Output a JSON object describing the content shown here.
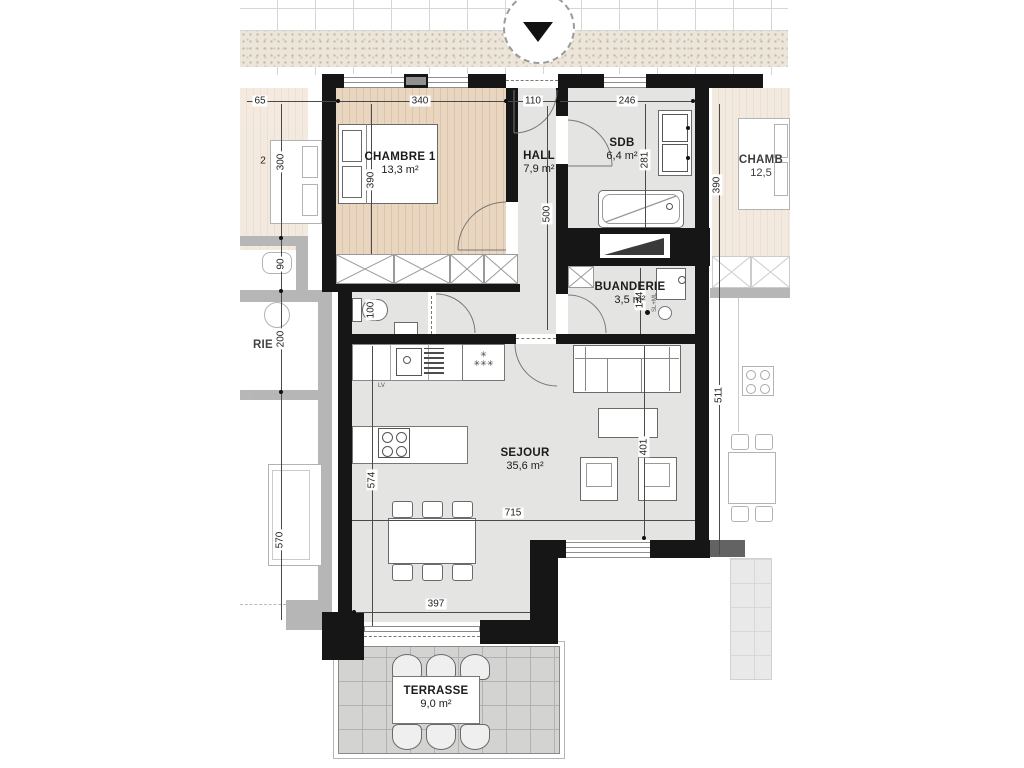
{
  "rooms": {
    "chambre1": {
      "name": "CHAMBRE 1",
      "area": "13,3 m²"
    },
    "hall": {
      "name": "HALL",
      "area": "7,9 m²"
    },
    "sdb": {
      "name": "SDB",
      "area": "6,4 m²"
    },
    "buanderie": {
      "name": "BUANDERIE",
      "area": "3,5 m²"
    },
    "sejour": {
      "name": "SEJOUR",
      "area": "35,6 m²"
    },
    "terrasse": {
      "name": "TERRASSE",
      "area": "9,0 m²"
    }
  },
  "dimensions_cm": {
    "chambre_width": "340",
    "hall_width": "110",
    "sdb_width": "246",
    "chambre_depth": "390",
    "hall_depth": "500",
    "sdb_depth": "281",
    "buanderie_depth": "144",
    "wc_width": "100",
    "sejour_depth_left": "574",
    "sejour_depth_right": "401",
    "sejour_width": "715",
    "sejour_width_lower": "397"
  },
  "neighbor_left": {
    "room_label_partial": "RIE",
    "dim_top": "65",
    "label_partial": "2",
    "dim_bedroom": "300",
    "dim_wc": "90",
    "dim_laundry": "200",
    "dim_living": "570"
  },
  "neighbor_right": {
    "room_label_partial": "CHAMB",
    "room_area_partial": "12,5",
    "dim_bedroom": "390",
    "dim_living": "511"
  },
  "annotations": {
    "freezer_star": "✳",
    "freezer_stars_three": "✳✳✳",
    "laundry_machines": "SL+ML",
    "dishwasher": "LV"
  },
  "colors": {
    "wall_main": "#161616",
    "wall_neighbor": "#6f6f6f",
    "wood_floor": "#e9d6c1",
    "gray_floor": "#e4e5e3",
    "terrace_tile": "#d3d4d2",
    "stipple_sand": "#ece5d9"
  }
}
